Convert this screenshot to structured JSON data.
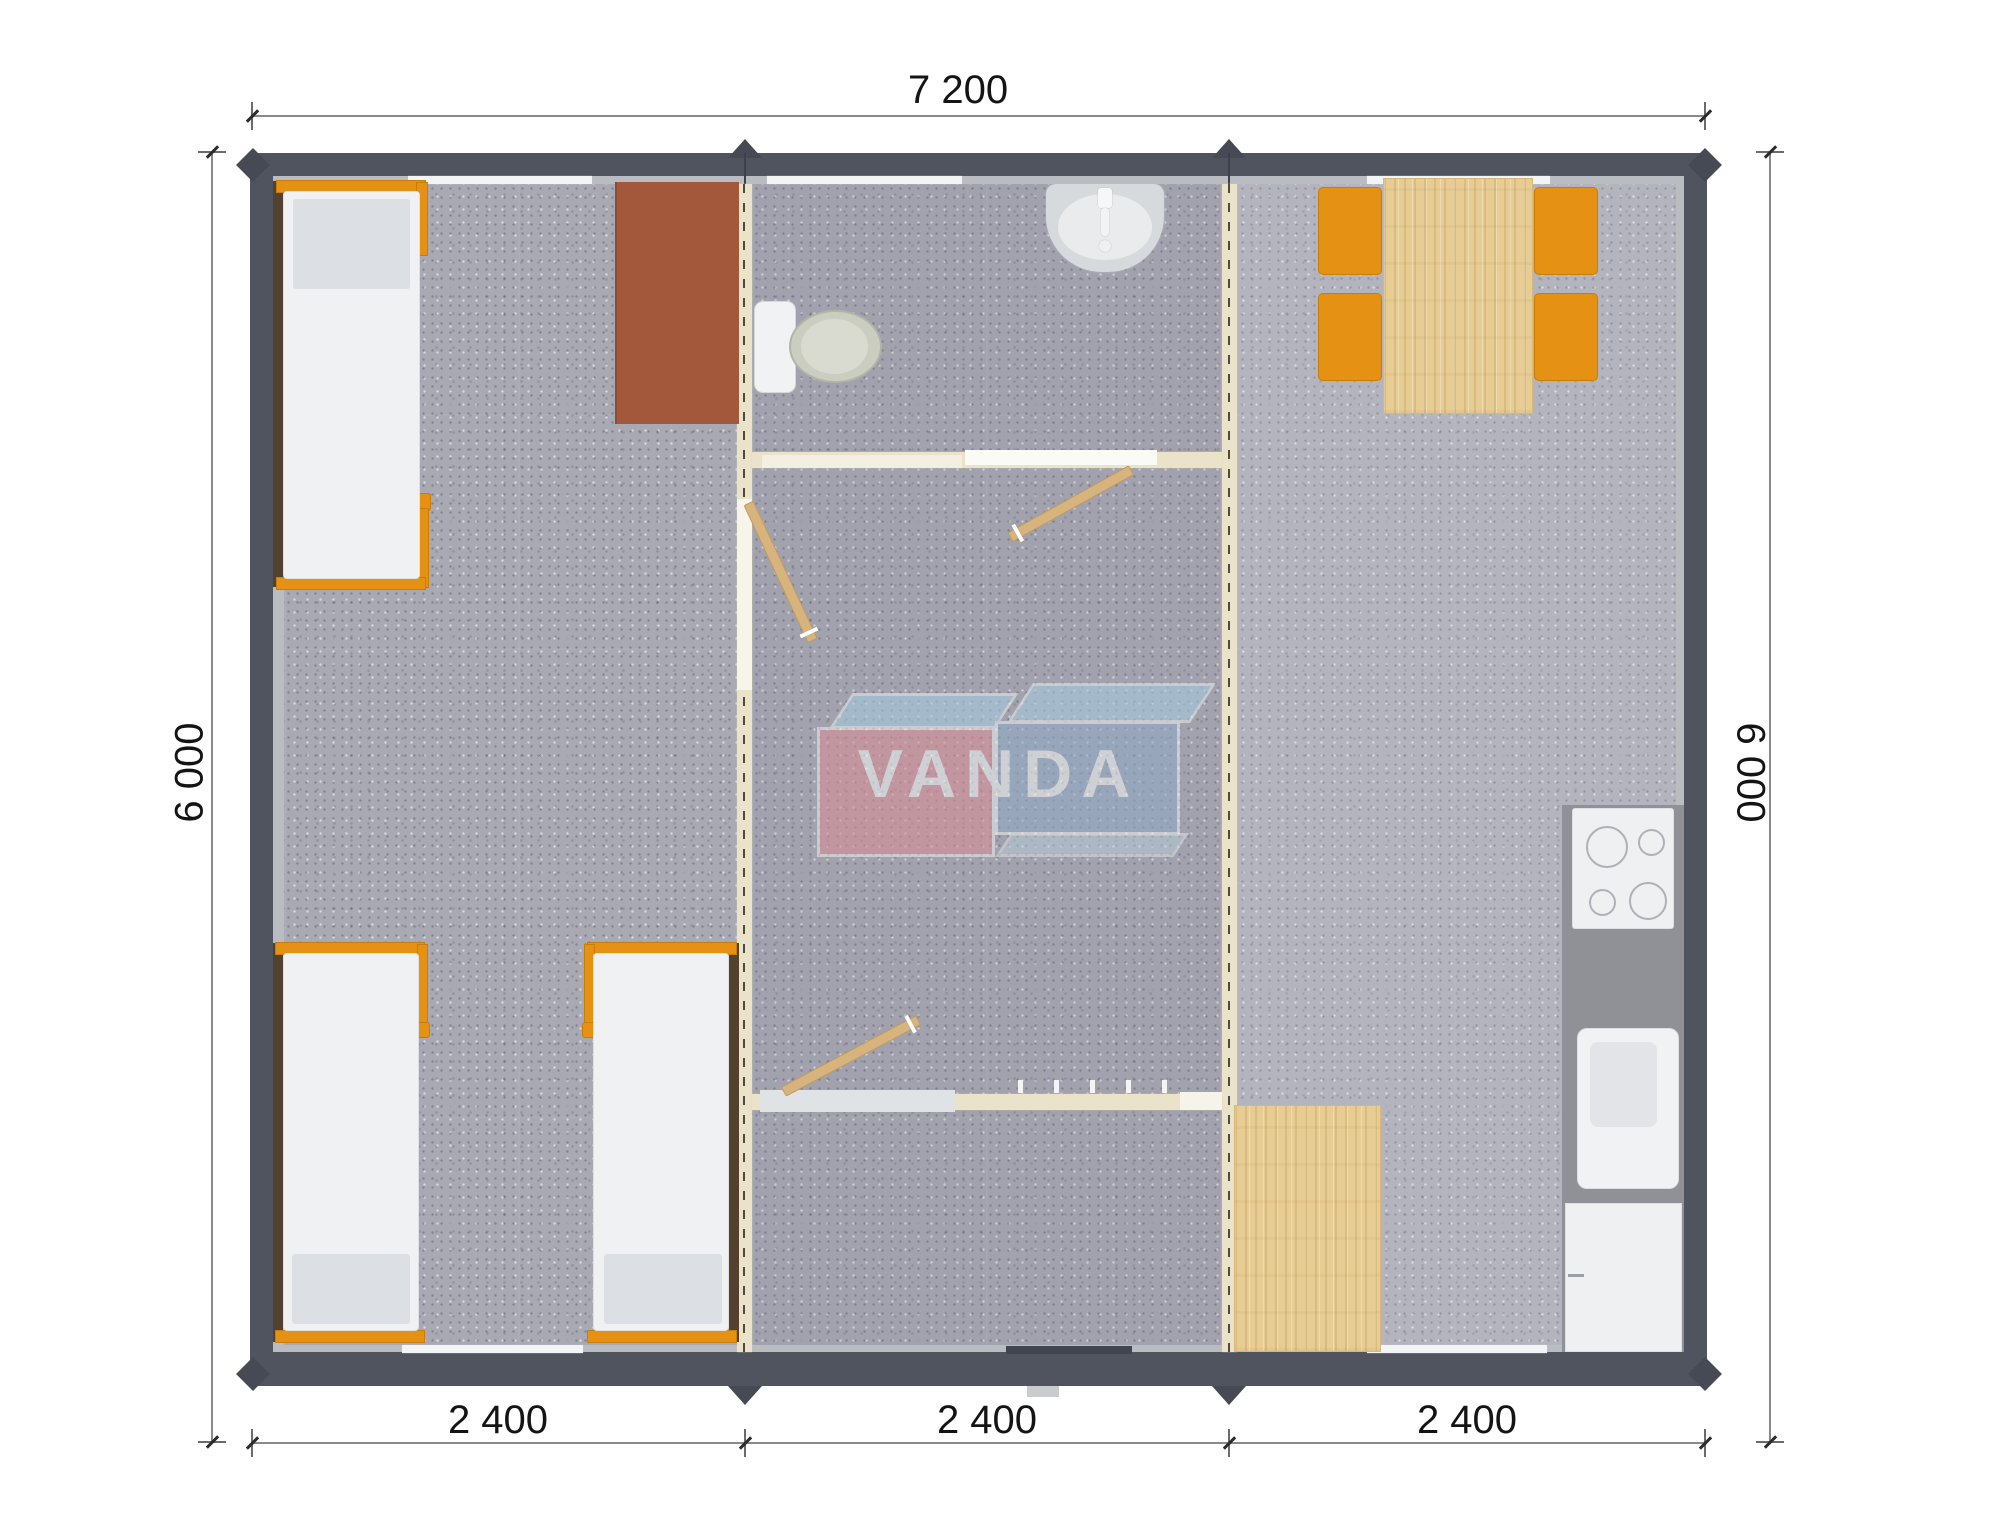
{
  "plan": {
    "type": "floor-plan",
    "brand_watermark": "VANDA",
    "overall_width_mm": "7 200",
    "overall_depth_mm": "6 000",
    "module_count": 3
  },
  "dimensions": {
    "top": {
      "label": "7 200"
    },
    "left": {
      "label": "6 000"
    },
    "right": {
      "label": "6 000"
    },
    "bottom": [
      {
        "label": "2 400"
      },
      {
        "label": "2 400"
      },
      {
        "label": "2 400"
      }
    ]
  },
  "watermark": {
    "text": "VANDA"
  },
  "rooms": {
    "left_room_items": [
      "single-bed",
      "single-bed",
      "single-bed",
      "desk"
    ],
    "middle_room_items": [
      "wash-basin",
      "toilet",
      "interior-door",
      "interior-door",
      "interior-door",
      "coat-hooks"
    ],
    "right_room_items": [
      "dining-table",
      "chair",
      "chair",
      "chair",
      "chair",
      "cooktop",
      "kitchen-sink",
      "base-cabinet",
      "wood-floor-mat"
    ]
  },
  "colors": {
    "wall": "#4f545e",
    "wall_liner": "#b9bcc1",
    "partition": "#ebe3c9",
    "carpet": "#a8a9b3",
    "accent_orange": "#e59113",
    "desk_brown": "#a3583c",
    "wood_light": "#e7cd94",
    "counter_gray": "#8f9197",
    "logo_pink": "#dc8d95",
    "logo_blue": "#92abc8",
    "logo_sky": "#a7cde0"
  }
}
